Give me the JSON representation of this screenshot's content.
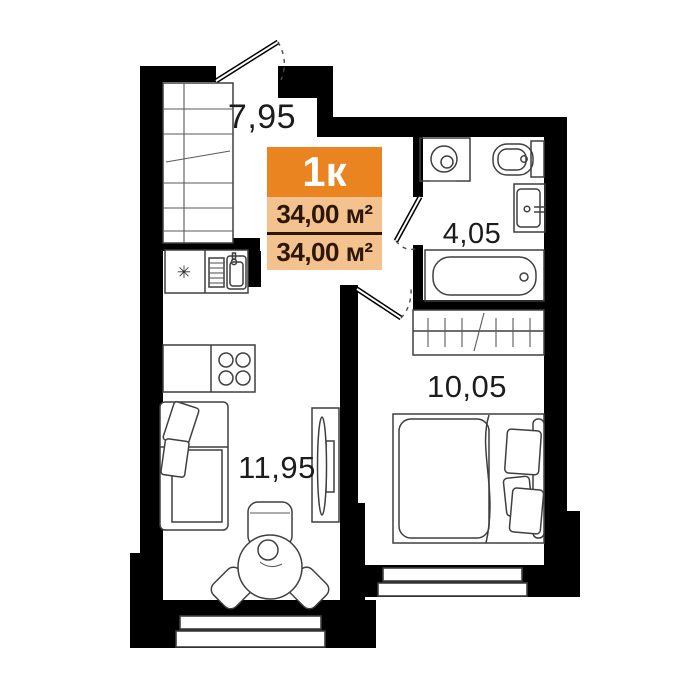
{
  "plan": {
    "badge": {
      "type": "1к",
      "total_area": "34,00 м²",
      "living_area": "34,00 м²"
    },
    "rooms": {
      "hallway": {
        "area": "7,95"
      },
      "bathroom": {
        "area": "4,05"
      },
      "bedroom": {
        "area": "10,05"
      },
      "living": {
        "area": "11,95"
      }
    },
    "icons": {
      "fridge": "✳"
    },
    "colors": {
      "wall": "#000000",
      "background": "#ffffff",
      "badge_header": "#e98420",
      "badge_body": "#f3c28e",
      "badge_text": "#2c1606",
      "furniture": "#3f3f3f",
      "label": "#1c1c1c"
    }
  }
}
